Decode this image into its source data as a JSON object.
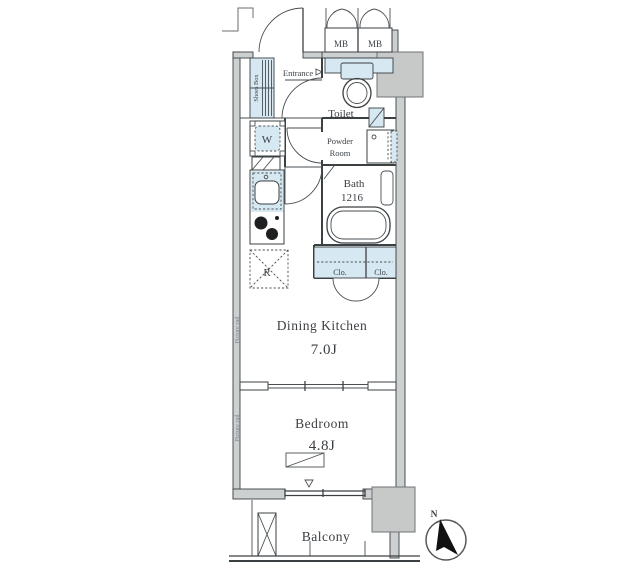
{
  "rooms": {
    "entrance": {
      "label": "Entrance"
    },
    "toilet": {
      "label": "Toilet"
    },
    "powder_room": {
      "label_line1": "Powder",
      "label_line2": "Room"
    },
    "bath": {
      "label": "Bath",
      "size": "1216"
    },
    "dining_kitchen": {
      "label": "Dining Kitchen",
      "area": "7.0J"
    },
    "bedroom": {
      "label": "Bedroom",
      "area": "4.8J"
    },
    "balcony": {
      "label": "Balcony"
    }
  },
  "fixtures": {
    "shoes_box": "Shoes Box",
    "washing_machine": "W",
    "refrigerator": "R",
    "closet_left": "Clo.",
    "closet_right": "Clo.",
    "meter_box_left": "MB",
    "meter_box_right": "MB"
  },
  "annotations": {
    "picture_rail_upper": "Picture rail",
    "picture_rail_lower": "Picture rail",
    "compass_north": "N"
  },
  "colors": {
    "fixture_fill": "#d6e8f2",
    "wall_fill": "#ccd0d1",
    "line": "#3b4043",
    "pillar_fill": "#c6c9c8",
    "needle": "#111111"
  }
}
